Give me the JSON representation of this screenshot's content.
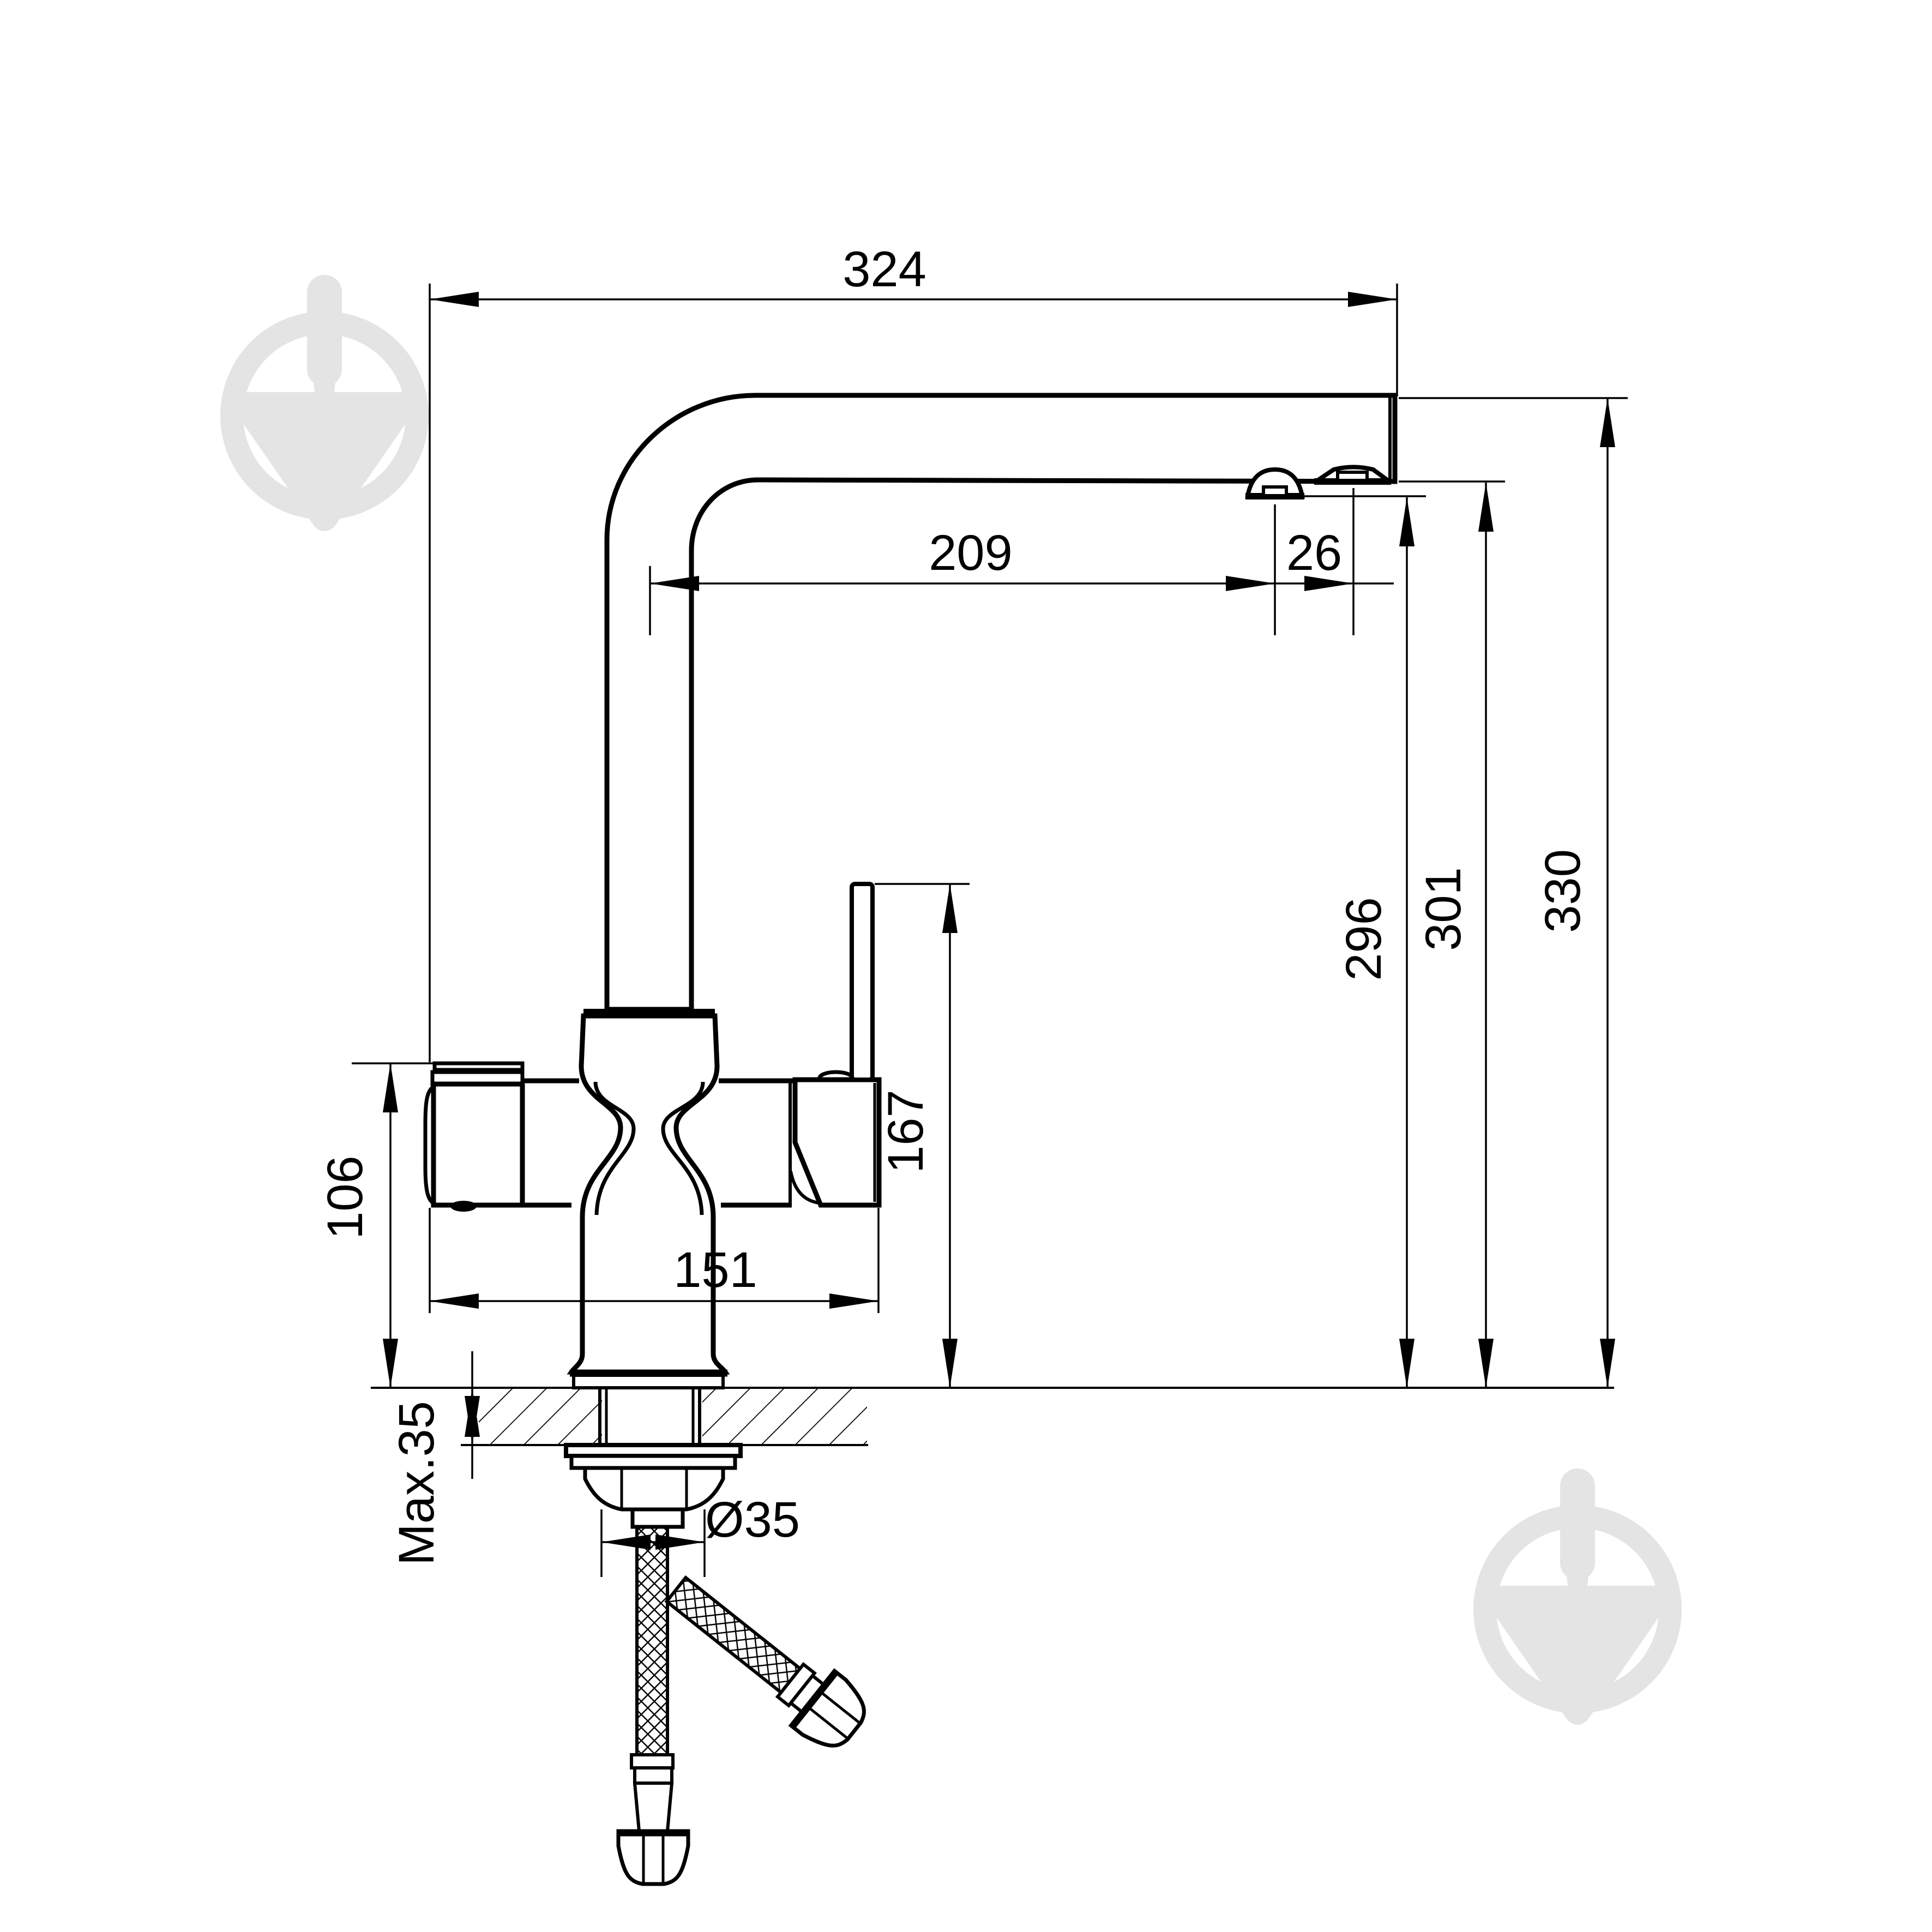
{
  "drawing": {
    "title": "faucet-installation-dimension-drawing",
    "dimensions": {
      "spout_reach_total": "324",
      "spout_projection": "209",
      "aerator_offset": "26",
      "height_small_aerator": "296",
      "height_outlet": "301",
      "height_total": "330",
      "lever_height": "167",
      "body_height": "106",
      "body_width": "151",
      "max_deck_thickness": "Max.35",
      "hole_diameter": "Ø35"
    },
    "colors": {
      "line": "#000000",
      "watermark": "#e4e4e4",
      "background": "#ffffff"
    }
  }
}
